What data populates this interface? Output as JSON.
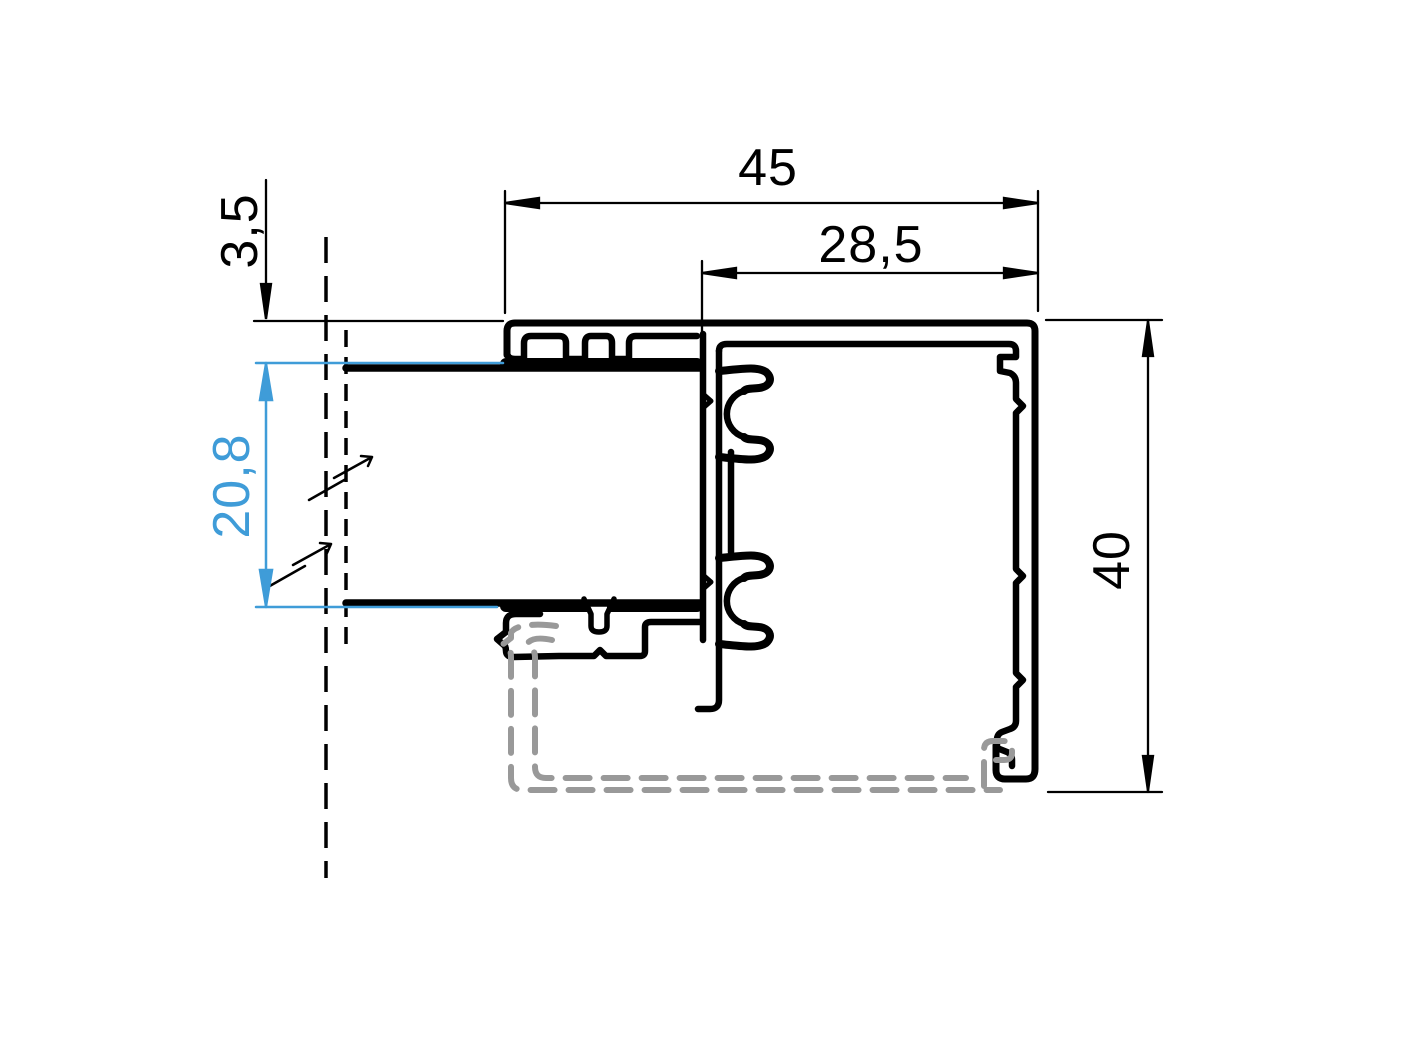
{
  "dimensions": {
    "total_width": "45",
    "sash_width": "28,5",
    "edge_gap": "3,5",
    "glass_thickness": "20,8",
    "frame_height": "40"
  },
  "colors": {
    "outline": "#000000",
    "glass_dimension_accent": "#3f9cd8",
    "hidden_profile_gray": "#999999",
    "background": "#ffffff"
  }
}
